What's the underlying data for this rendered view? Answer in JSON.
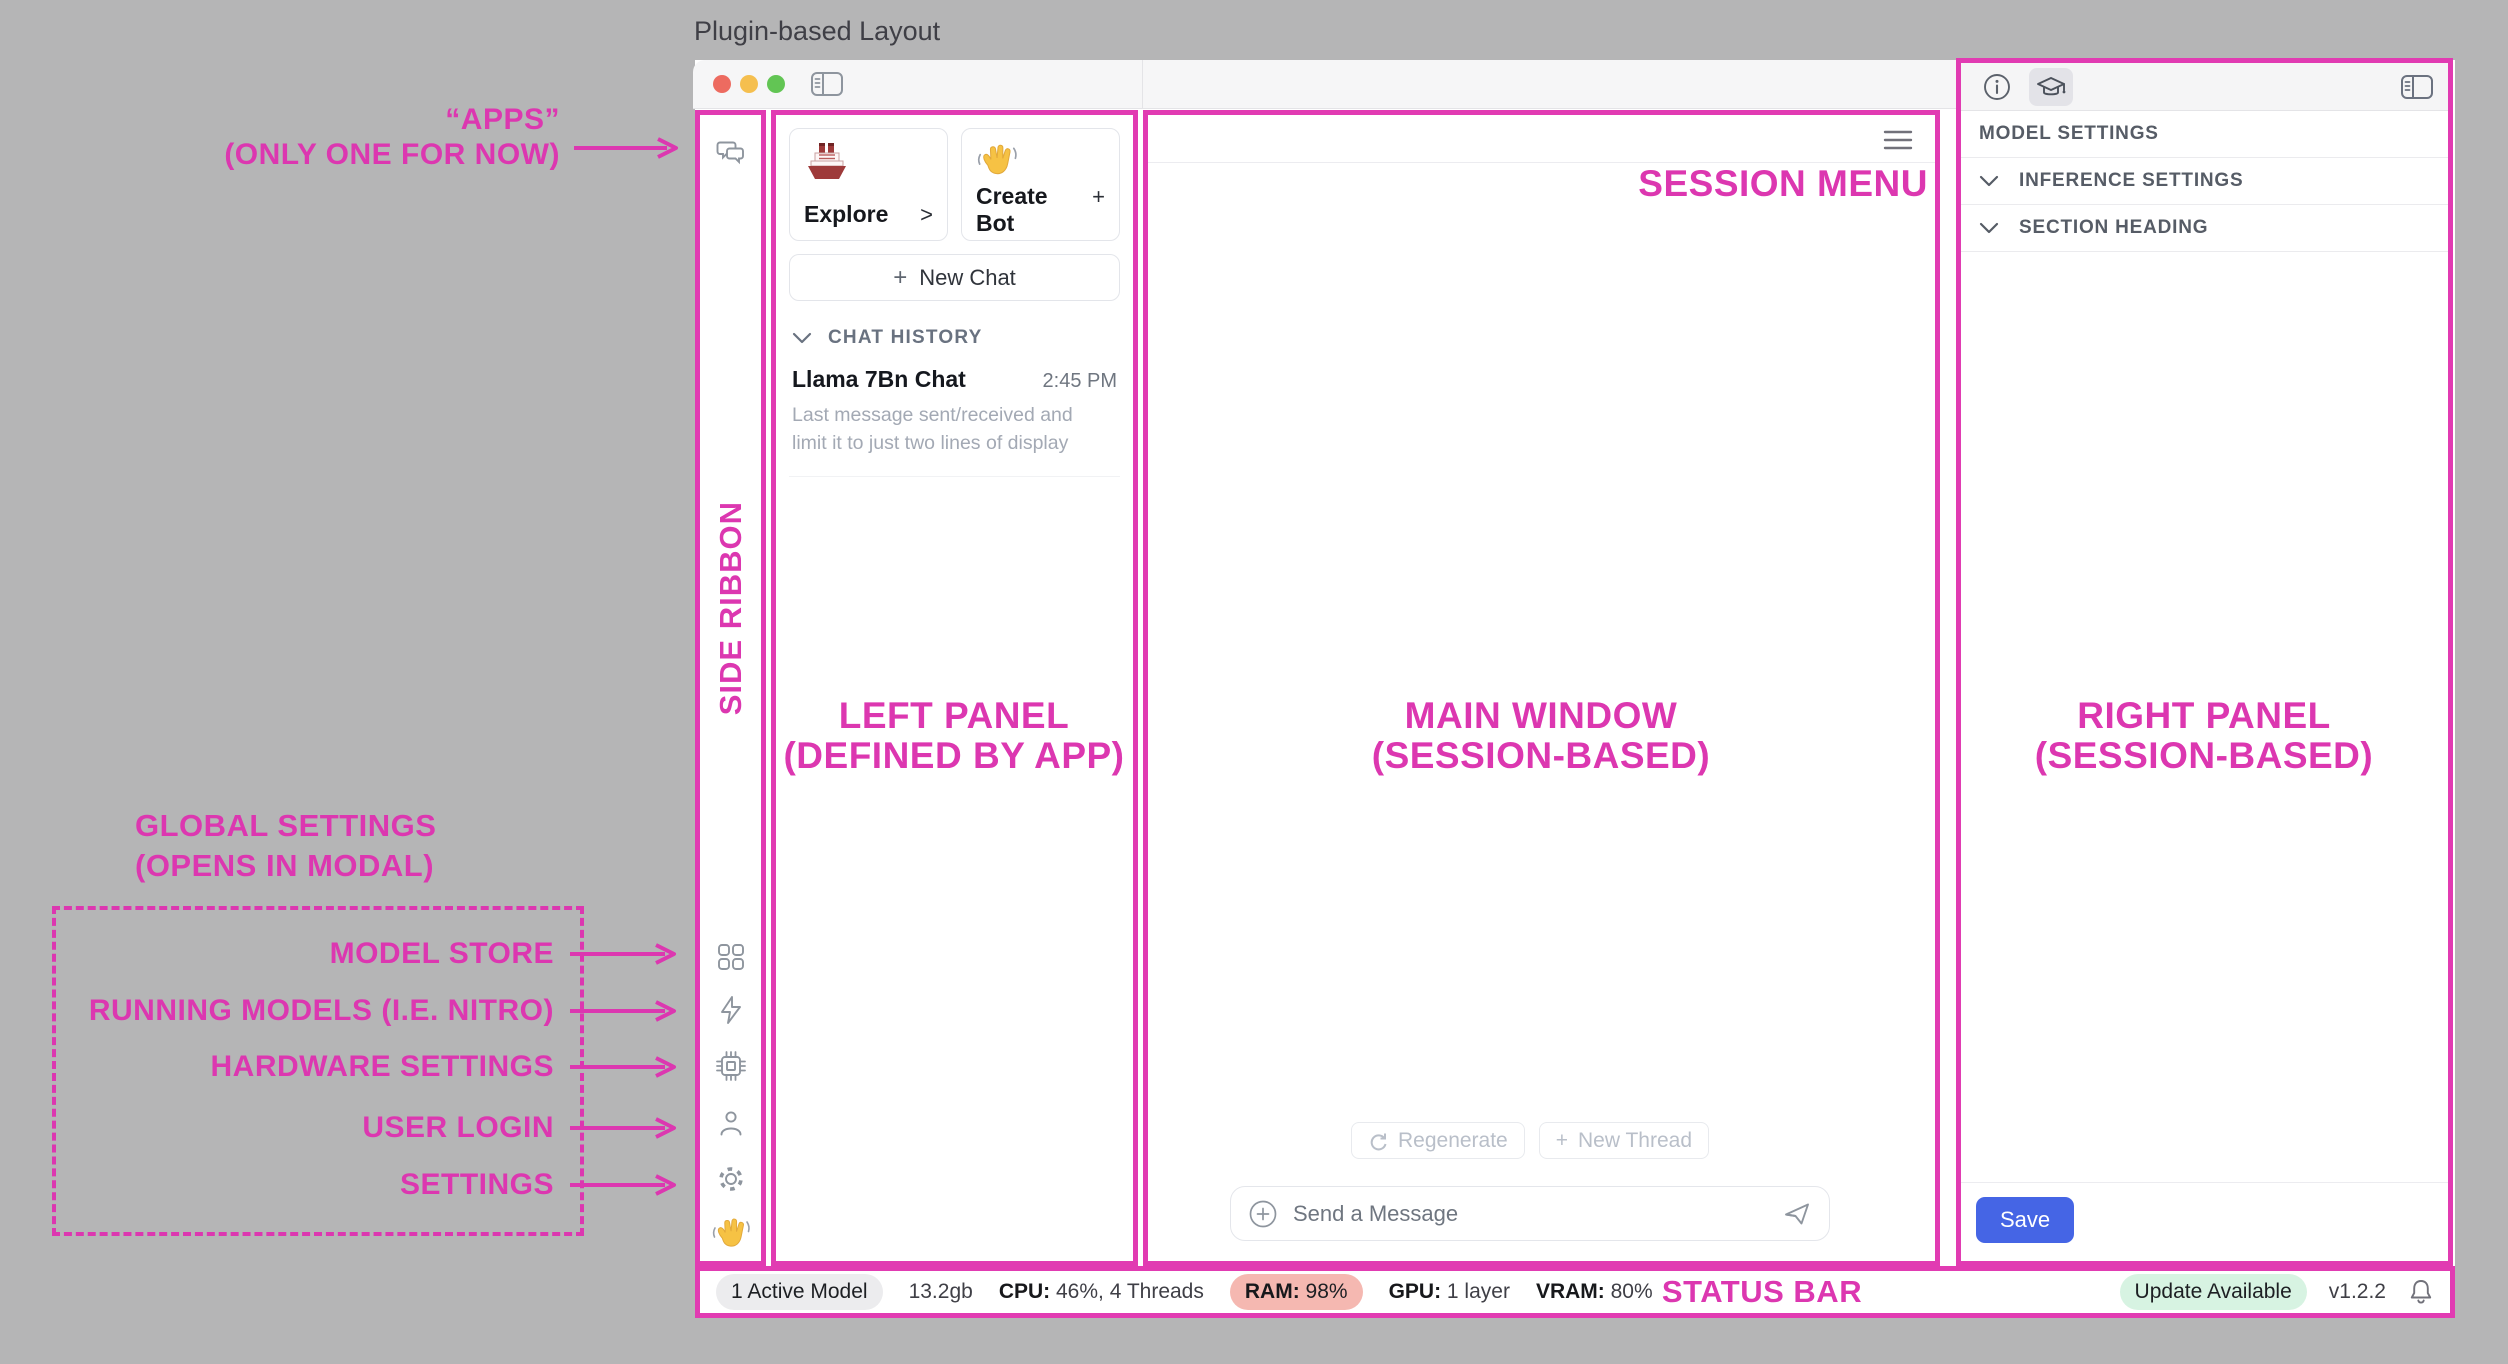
{
  "colors": {
    "annotation_pink": "#dc37b0",
    "frame_pink": "#e13bb2",
    "save_blue": "#4565e5",
    "ram_badge_bg": "#f5b8b1",
    "update_badge_bg": "#d7f3e2",
    "active_model_badge_bg": "#ececee"
  },
  "page_title": "Plugin-based Layout",
  "annotations": {
    "apps_line1": "“APPS”",
    "apps_line2": "(ONLY ONE FOR NOW)",
    "side_ribbon": "SIDE RIBBON",
    "left_panel_line1": "LEFT PANEL",
    "left_panel_line2": "(DEFINED BY APP)",
    "main_window_line1": "MAIN WINDOW",
    "main_window_line2": "(SESSION-BASED)",
    "right_panel_line1": "RIGHT PANEL",
    "right_panel_line2": "(SESSION-BASED)",
    "session_menu": "SESSION MENU",
    "status_bar": "STATUS BAR",
    "global_settings_line1": "GLOBAL SETTINGS",
    "global_settings_line2": "(OPENS IN MODAL)",
    "modal_items": [
      {
        "label": "MODEL STORE",
        "target_icon": "apps-grid-icon"
      },
      {
        "label": "RUNNING MODELS (I.E. NITRO)",
        "target_icon": "bolt-icon"
      },
      {
        "label": "HARDWARE SETTINGS",
        "target_icon": "chip-icon"
      },
      {
        "label": "USER LOGIN",
        "target_icon": "user-icon"
      },
      {
        "label": "SETTINGS",
        "target_icon": "gear-icon"
      }
    ]
  },
  "side_ribbon": {
    "top_icon": "chat-bubbles-icon",
    "bottom_icons": [
      "apps-grid-icon",
      "bolt-icon",
      "chip-icon",
      "user-icon",
      "gear-icon",
      "wave-hand-icon"
    ]
  },
  "left_panel": {
    "cards": [
      {
        "icon": "ship-emoji",
        "label": "Explore",
        "action": ">"
      },
      {
        "icon": "wave-emoji",
        "label": "Create Bot",
        "action": "+"
      }
    ],
    "new_chat_plus": "+",
    "new_chat_label": "New Chat",
    "history_header": "CHAT HISTORY",
    "history_items": [
      {
        "title": "Llama 7Bn Chat",
        "time": "2:45 PM",
        "preview": "Last message sent/received and limit it to just two lines of display"
      }
    ]
  },
  "main_window": {
    "regenerate_label": "Regenerate",
    "new_thread_plus": "+",
    "new_thread_label": "New Thread",
    "composer_placeholder": "Send a Message"
  },
  "right_panel": {
    "tools": [
      "info-icon",
      "graduation-cap-icon",
      "panel-toggle-icon"
    ],
    "header": "MODEL SETTINGS",
    "sections": [
      {
        "label": "INFERENCE SETTINGS"
      },
      {
        "label": "SECTION HEADING"
      }
    ],
    "save_label": "Save"
  },
  "status_bar": {
    "active_model": "1 Active Model",
    "memory": "13.2gb",
    "cpu_label": "CPU:",
    "cpu_value": " 46%, 4 Threads",
    "ram_label": "RAM:",
    "ram_value": " 98%",
    "gpu_label": "GPU:",
    "gpu_value": " 1 layer",
    "vram_label": "VRAM:",
    "vram_value": " 80%",
    "update_badge": "Update Available",
    "version": "v1.2.2"
  }
}
